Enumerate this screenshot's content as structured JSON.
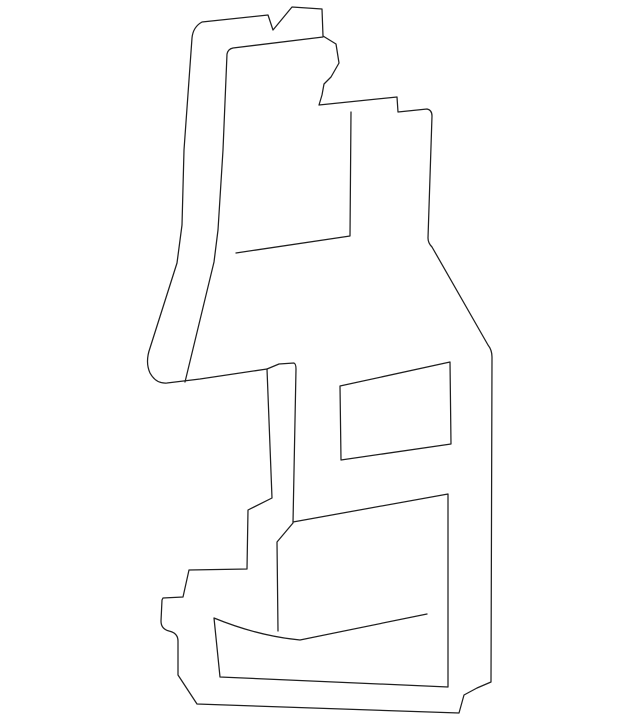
{
  "page": {
    "background_color": "#ffffff"
  },
  "diagram": {
    "viewbox": "0 0 640 725",
    "stroke_color": "#1f1f1f",
    "stroke_width": 1.25,
    "fill": "none",
    "paths": [
      {
        "name": "part-outer-outline",
        "d": "M 202 22 L 268 15 L 273 30 L 292 7 L 322 9 L 323 36 L 336 44 L 339 63 L 331 77 L 324 84 L 322 95 L 319 105 L 397 97 L 398 112 L 427 109 Q 432 110 432 116 L 428 238 Q 428 243 432 247 L 488 345 Q 492 350 492 357 L 491 682 L 477 688 L 464 695 L 459 713 L 197 704 L 178 675 L 178 641 Q 178 633 169 631 Q 161 629 161 621 L 162 600 L 163 598 L 183 597 L 189 570 L 247 569 L 248 510 L 272 498 L 267 369 L 200 379 L 167 383 Q 156 384 150 373 Q 145 362 150 348 L 177 263 L 182 225 L 184 150 L 192 38 Q 193 27 202 22 Z"
      },
      {
        "name": "part-inner-top-edge",
        "d": "M 323 37 L 233 48 Q 228 49 227 54 L 223 150 L 218 230 L 214 262 L 185 382"
      },
      {
        "name": "part-center-fold-line",
        "d": "M 267 369 L 279 364 L 294 363 Q 296 364 296 369 L 293 523 L 277 542 L 278 631"
      },
      {
        "name": "part-upper-recess-edge",
        "d": "M 351 112 L 350 236 L 236 253"
      },
      {
        "name": "part-window-cutout",
        "d": "M 340 386 L 450 362 L 451 444 L 341 460 Z"
      },
      {
        "name": "part-lower-panel",
        "d": "M 293 522 L 448 494 L 448 687 L 220 677 L 214 618 Q 258 636 300 640 L 427 614"
      }
    ]
  }
}
